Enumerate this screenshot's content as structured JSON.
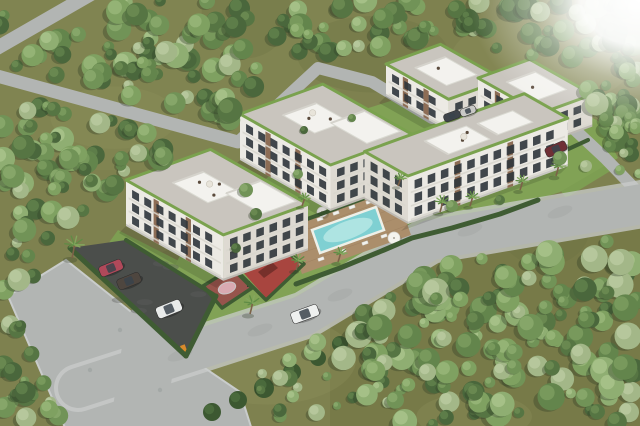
{
  "meta": {
    "description": "aerial-3d-render-of-residential-complex",
    "width": 640,
    "height": 426
  },
  "palette": {
    "groundBase": "#7e814f",
    "groundDark": "#6b6f41",
    "groundLight": "#8e925c",
    "groundTintBR": "#6f713f",
    "road": "#b2b5b3",
    "roadLight": "#c9cccb",
    "roadDark": "#9aa09c",
    "parking": "#4b4e4b",
    "parkingLight": "#5d605d",
    "hedge": "#3f5c33",
    "faceMain": "#eceae4",
    "faceSide": "#dedad2",
    "windowDark": "#2f353b",
    "brick": "#8d6d55",
    "rail": "#d8d6ce",
    "roofPaver": "#c9c5be",
    "roofGreen": "#7aa24e",
    "roofBox": "#f3f2ee",
    "roofBoxShade": "#d5d3cc",
    "poolWater": "#7fd0d2",
    "poolInner": "#bdebe7",
    "poolRim": "#eef0e8",
    "deckWood": "#ab8e6b",
    "deckLine": "#97795a",
    "courtRed": "#97544c",
    "courtPink": "#d9a9b1",
    "playRed": "#a8453f",
    "playDark": "#76302b",
    "lawn": "#7d9e52",
    "lawnLight": "#8fae60",
    "palmTrunk": "#7c6248",
    "palmLeaf": "#5f8c45",
    "palmLeafLight": "#83a85e",
    "treeShadow": "#2e3b26",
    "gate": "#d98a2b",
    "chair": "#f2f2ee",
    "trees": [
      [
        "#4a673c",
        "#5f7f4a"
      ],
      [
        "#567543",
        "#6c8b52"
      ],
      [
        "#63854c",
        "#7a9b5e"
      ],
      [
        "#719357",
        "#88a86b"
      ],
      [
        "#7fa161",
        "#97b578"
      ],
      [
        "#8fae72",
        "#a7c28a"
      ],
      [
        "#a3b788",
        "#b8c99e"
      ]
    ],
    "bush": [
      "#3c5831",
      "#4a6a3c"
    ],
    "carGlass": "#39434b"
  },
  "scene": {
    "groundMottles": 12,
    "roads": [
      {
        "name": "road-top-left",
        "pts": [
          [
            -10,
            52
          ],
          [
            98,
            -10
          ]
        ],
        "w": 14
      },
      {
        "name": "road-upper-left",
        "pts": [
          [
            -10,
            74
          ],
          [
            238,
            142
          ]
        ],
        "w": 13
      },
      {
        "name": "road-internal-drive",
        "pts": [
          [
            238,
            142
          ],
          [
            318,
            68
          ],
          [
            372,
            82
          ],
          [
            432,
            118
          ],
          [
            472,
            112
          ],
          [
            540,
            94
          ],
          [
            575,
            130
          ],
          [
            605,
            158
          ],
          [
            634,
            188
          ]
        ],
        "w": 12
      },
      {
        "name": "road-front-main",
        "pts": [
          [
            78,
            388
          ],
          [
            305,
            315
          ],
          [
            430,
            240
          ],
          [
            648,
            203
          ]
        ],
        "w": 40,
        "sidewalk": 48
      },
      {
        "name": "road-bottom-exit",
        "pts": [
          [
            152,
            328
          ],
          [
            136,
            436
          ]
        ],
        "w": 54
      }
    ],
    "roadBlotches": [
      [
        180,
        355
      ],
      [
        260,
        330
      ],
      [
        340,
        295
      ],
      [
        470,
        230
      ],
      [
        560,
        212
      ]
    ],
    "plaza": [
      [
        8,
        296
      ],
      [
        66,
        260
      ],
      [
        184,
        354
      ],
      [
        240,
        392
      ],
      [
        252,
        430
      ],
      [
        66,
        430
      ]
    ],
    "manholes": [
      [
        120,
        330
      ],
      [
        90,
        370
      ],
      [
        160,
        390
      ]
    ],
    "lawns": [
      {
        "name": "courtyard-lawn",
        "pts": [
          [
            150,
            310
          ],
          [
            190,
            238
          ],
          [
            242,
            198
          ],
          [
            302,
            150
          ],
          [
            362,
            110
          ],
          [
            432,
            88
          ],
          [
            522,
            80
          ],
          [
            600,
            122
          ],
          [
            618,
            158
          ],
          [
            560,
            192
          ],
          [
            500,
            212
          ],
          [
            440,
            232
          ],
          [
            380,
            254
          ],
          [
            318,
            284
          ],
          [
            268,
            312
          ],
          [
            208,
            332
          ]
        ]
      },
      {
        "name": "front-lawn-left",
        "pts": [
          [
            118,
            230
          ],
          [
            228,
            286
          ],
          [
            216,
            300
          ],
          [
            108,
            244
          ]
        ]
      },
      {
        "name": "right-garden",
        "pts": [
          [
            540,
            162
          ],
          [
            588,
            140
          ],
          [
            612,
            170
          ],
          [
            566,
            198
          ]
        ]
      }
    ],
    "parking": {
      "poly": [
        [
          70,
          248
        ],
        [
          126,
          240
        ],
        [
          216,
          296
        ],
        [
          186,
          356
        ]
      ],
      "gate": [
        180,
        346
      ]
    },
    "court": {
      "poly": [
        [
          203,
          286
        ],
        [
          232,
          268
        ],
        [
          252,
          288
        ],
        [
          222,
          308
        ]
      ],
      "center": [
        227,
        288
      ],
      "rx": 9,
      "ry": 5.5,
      "hoop": [
        247,
        281
      ]
    },
    "playground": {
      "poly": [
        [
          234,
          262
        ],
        [
          272,
          240
        ],
        [
          304,
          264
        ],
        [
          266,
          298
        ]
      ],
      "slides": [
        [
          [
            248,
            262
          ],
          [
            262,
            252
          ],
          [
            268,
            258
          ],
          [
            254,
            268
          ]
        ],
        [
          [
            258,
            272
          ],
          [
            272,
            262
          ],
          [
            278,
            268
          ],
          [
            264,
            278
          ]
        ]
      ]
    },
    "pergolas": [
      [
        276,
        242
      ],
      [
        292,
        234
      ],
      [
        308,
        226
      ]
    ],
    "deck": {
      "poly": [
        [
          285,
          225
        ],
        [
          394,
          186
        ],
        [
          411,
          235
        ],
        [
          302,
          274
        ]
      ],
      "chairs": [
        [
          303,
          225
        ],
        [
          320,
          219
        ],
        [
          336,
          213
        ],
        [
          352,
          207
        ],
        [
          369,
          202
        ],
        [
          321,
          259
        ],
        [
          343,
          251
        ],
        [
          365,
          243
        ],
        [
          384,
          236
        ]
      ],
      "umbrellas": [
        [
          322,
          212,
          5
        ],
        [
          394,
          238,
          6
        ]
      ]
    },
    "pool": {
      "poly": [
        [
          312,
          230
        ],
        [
          376,
          207
        ],
        [
          384,
          230
        ],
        [
          320,
          253
        ]
      ],
      "inner": [
        348,
        230,
        26,
        9
      ]
    },
    "hedgeLines": [
      {
        "pts": [
          [
            296,
            284
          ],
          [
            340,
            268
          ],
          [
            384,
            250
          ],
          [
            412,
            238
          ],
          [
            452,
            228
          ],
          [
            500,
            214
          ],
          [
            538,
            200
          ]
        ],
        "w": 5
      },
      {
        "pts": [
          [
            70,
            248
          ],
          [
            186,
            356
          ]
        ],
        "w": 5
      },
      {
        "pts": [
          [
            186,
            356
          ],
          [
            216,
            296
          ]
        ],
        "w": 5
      },
      {
        "pts": [
          [
            126,
            240
          ],
          [
            216,
            296
          ]
        ],
        "w": 4
      },
      {
        "pts": [
          [
            228,
            262
          ],
          [
            268,
            240
          ],
          [
            304,
            264
          ],
          [
            266,
            300
          ],
          [
            230,
            264
          ]
        ],
        "w": 3.5
      },
      {
        "pts": [
          [
            203,
            286
          ],
          [
            232,
            268
          ],
          [
            252,
            288
          ],
          [
            222,
            308
          ],
          [
            205,
            288
          ]
        ],
        "w": 3.5
      },
      {
        "pts": [
          [
            288,
            226
          ],
          [
            398,
            186
          ]
        ],
        "w": 4
      },
      {
        "pts": [
          [
            540,
            162
          ],
          [
            588,
            140
          ]
        ],
        "w": 4
      }
    ],
    "buildings": [
      {
        "name": "apartment-block-rear-a",
        "p": [
          386,
          96
        ],
        "axis": "block",
        "L": 72,
        "h": 32,
        "D": 58,
        "floors": 2,
        "boxes": [
          [
            0.25,
            0.75,
            0.25,
            0.8
          ]
        ],
        "furn": [
          [
            0.4,
            0.5
          ]
        ]
      },
      {
        "name": "apartment-block-rear-b",
        "p": [
          478,
          110
        ],
        "axis": "block",
        "L": 72,
        "h": 32,
        "D": 55,
        "floors": 2,
        "boxes": [
          [
            0.25,
            0.75,
            0.25,
            0.8
          ]
        ],
        "furn": [
          [
            0.5,
            0.45
          ]
        ]
      },
      {
        "name": "apartment-block-middle",
        "p": [
          240,
          160
        ],
        "axis": "block",
        "L": 104,
        "h": 46,
        "D": 88,
        "floors": 3,
        "boxes": [
          [
            0.2,
            0.55,
            0.3,
            0.7
          ],
          [
            0.5,
            0.9,
            0.55,
            0.95
          ]
        ],
        "furn": [
          [
            0.35,
            0.45
          ],
          [
            0.45,
            0.6
          ]
        ],
        "umb": [
          0.3,
          0.55
        ]
      },
      {
        "name": "apartment-block-left",
        "p": [
          126,
          226
        ],
        "axis": "block",
        "L": 112,
        "h": 46,
        "D": 90,
        "floors": 3,
        "boxes": [
          [
            0.22,
            0.58,
            0.3,
            0.66
          ],
          [
            0.55,
            0.92,
            0.55,
            0.95
          ]
        ],
        "furn": [
          [
            0.32,
            0.5
          ],
          [
            0.42,
            0.62
          ],
          [
            0.52,
            0.44
          ]
        ],
        "umb": [
          0.38,
          0.55
        ]
      },
      {
        "name": "apartment-block-front-right",
        "p": [
          408,
          224
        ],
        "axis": "row",
        "L": 170,
        "h": 48,
        "D": 50,
        "floors": 3,
        "boxes": [
          [
            0.3,
            0.56,
            0.18,
            0.72
          ],
          [
            0.62,
            0.84,
            0.22,
            0.68
          ]
        ],
        "furn": [
          [
            0.45,
            0.4
          ],
          [
            0.52,
            0.55
          ]
        ],
        "umb": [
          0.48,
          0.48
        ]
      }
    ],
    "cars": [
      {
        "name": "parked-car-red",
        "x": 111,
        "y": 268,
        "a": -22,
        "c": "#b0495a",
        "l": 24,
        "w": 11
      },
      {
        "name": "parked-car-dark",
        "x": 129,
        "y": 281,
        "a": -22,
        "c": "#4e463f",
        "l": 24,
        "w": 11
      },
      {
        "name": "parked-car-white",
        "x": 169,
        "y": 309,
        "a": -22,
        "c": "#e9ebea",
        "l": 26,
        "w": 12
      },
      {
        "name": "moving-car-white",
        "x": 305,
        "y": 314,
        "a": -20,
        "c": "#eef0ef",
        "l": 28,
        "w": 12
      },
      {
        "name": "parked-car-darkred",
        "x": 556,
        "y": 149,
        "a": -24,
        "c": "#6f2f35",
        "l": 22,
        "w": 10
      },
      {
        "name": "drive-car-dark",
        "x": 452,
        "y": 116,
        "a": -20,
        "c": "#3f444a",
        "l": 17,
        "w": 8
      },
      {
        "name": "drive-car-silver",
        "x": 468,
        "y": 111,
        "a": -20,
        "c": "#c9c9c6",
        "l": 16,
        "w": 8
      }
    ],
    "palms": [
      [
        72,
        258,
        1.2
      ],
      [
        250,
        314,
        1.0
      ],
      [
        296,
        270,
        0.85
      ],
      [
        338,
        262,
        0.8
      ],
      [
        440,
        212,
        0.9
      ],
      [
        470,
        206,
        0.8
      ],
      [
        520,
        190,
        0.8
      ],
      [
        556,
        176,
        0.9
      ],
      [
        302,
        206,
        0.7
      ],
      [
        398,
        186,
        0.7
      ]
    ],
    "innerTrees": [
      [
        246,
        190,
        7
      ],
      [
        256,
        214,
        6
      ],
      [
        236,
        248,
        5
      ],
      [
        298,
        174,
        5
      ],
      [
        452,
        206,
        6
      ],
      [
        500,
        200,
        5
      ],
      [
        560,
        158,
        7
      ],
      [
        586,
        166,
        6
      ],
      [
        610,
        146,
        6
      ],
      [
        352,
        118,
        4
      ],
      [
        304,
        130,
        4
      ],
      [
        620,
        170,
        5
      ]
    ],
    "bushes": [
      [
        212,
        412,
        9
      ],
      [
        238,
        400,
        9
      ],
      [
        264,
        388,
        10
      ],
      [
        292,
        372,
        9
      ],
      [
        318,
        358,
        8
      ],
      [
        340,
        344,
        8
      ]
    ],
    "treeZones": [
      {
        "x": 0,
        "y": 0,
        "w": 340,
        "h": 170,
        "n": 115,
        "rmin": 5,
        "rmax": 13
      },
      {
        "x": 340,
        "y": 0,
        "w": 300,
        "h": 150,
        "n": 90,
        "rmin": 5,
        "rmax": 12
      },
      {
        "x": 0,
        "y": 150,
        "w": 125,
        "h": 145,
        "n": 36,
        "rmin": 5,
        "rmax": 12
      },
      {
        "x": 330,
        "y": 215,
        "w": 310,
        "h": 211,
        "n": 155,
        "rmin": 5,
        "rmax": 14
      },
      {
        "x": 0,
        "y": 318,
        "w": 74,
        "h": 108,
        "n": 20,
        "rmin": 4,
        "rmax": 11
      },
      {
        "x": 225,
        "y": 340,
        "w": 115,
        "h": 86,
        "n": 14,
        "rmin": 4,
        "rmax": 9
      },
      {
        "x": 596,
        "y": 118,
        "w": 44,
        "h": 100,
        "n": 10,
        "rmin": 4,
        "rmax": 8
      }
    ],
    "hull": [
      [
        60,
        248
      ],
      [
        120,
        188
      ],
      [
        240,
        126
      ],
      [
        320,
        56
      ],
      [
        445,
        38
      ],
      [
        565,
        62
      ],
      [
        600,
        110
      ],
      [
        618,
        160
      ],
      [
        606,
        204
      ],
      [
        560,
        210
      ],
      [
        465,
        240
      ],
      [
        380,
        260
      ],
      [
        300,
        300
      ],
      [
        252,
        336
      ],
      [
        258,
        430
      ],
      [
        76,
        430
      ],
      [
        62,
        336
      ]
    ],
    "whiteCorner": {
      "x": 470,
      "y": 0,
      "w": 170,
      "h": 130
    }
  }
}
